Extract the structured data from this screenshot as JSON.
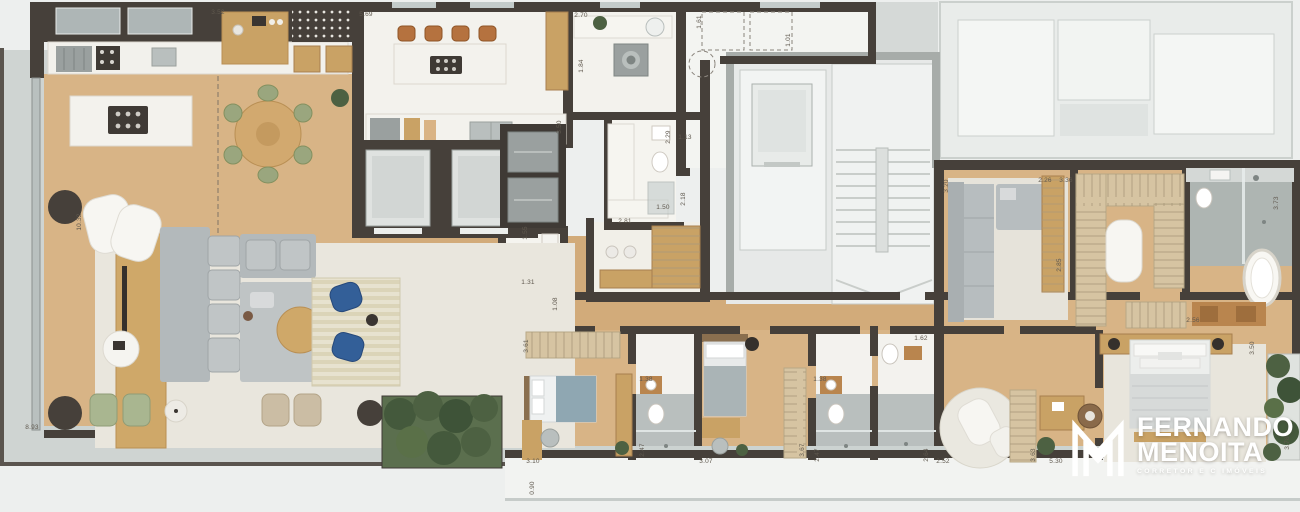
{
  "plan": {
    "kind": "residential floor plan (top-down render)",
    "units": "meters"
  },
  "logo": {
    "line1": "FERNANDO",
    "line2": "MENOITA",
    "tagline": "CORRETOR E C IMÓVEIS",
    "monogram": "M"
  },
  "colors": {
    "background": "#edefee",
    "wall": "#46403a",
    "common_wall": "#a7aca9",
    "wood": "#d8b486",
    "wood_dark": "#cfa875",
    "white_floor": "#f3f2ed",
    "rug": "#e9e6dd",
    "concrete": "#cfd4d2",
    "common_floor": "#e7e9e8",
    "glass": "#bcc4c4",
    "sofa_gray": "#b7bdbf",
    "chair_green": "#a9b690",
    "chair_blue": "#335f98",
    "chair_tan": "#cbbda4",
    "stool_leather": "#b5723f",
    "wardrobe_tan": "#d6c4a2",
    "wood_furniture": "#c9a265",
    "cork": "#b9854e",
    "plant_green": "#4d6142",
    "planter_dark": "#46403a",
    "bath_gray": "#b9bfbe",
    "appliance_gray": "#9aa09f",
    "label_text": "#5f584e",
    "logo_white": "#ffffff"
  },
  "dimensions": [
    {
      "label": "3.52",
      "x": 218,
      "y": 13,
      "vertical": false
    },
    {
      "label": "5.69",
      "x": 366,
      "y": 15,
      "vertical": false
    },
    {
      "label": "2.70",
      "x": 581,
      "y": 16,
      "vertical": false
    },
    {
      "label": "1.61",
      "x": 700,
      "y": 22,
      "vertical": true
    },
    {
      "label": "1.01",
      "x": 789,
      "y": 40,
      "vertical": true
    },
    {
      "label": "10.32",
      "x": 80,
      "y": 222,
      "vertical": true
    },
    {
      "label": "1.84",
      "x": 582,
      "y": 66,
      "vertical": true
    },
    {
      "label": "3.50",
      "x": 560,
      "y": 127,
      "vertical": true
    },
    {
      "label": "1.13",
      "x": 685,
      "y": 138,
      "vertical": false
    },
    {
      "label": "2.29",
      "x": 669,
      "y": 137,
      "vertical": true
    },
    {
      "label": "2.18",
      "x": 684,
      "y": 199,
      "vertical": true
    },
    {
      "label": "1.50",
      "x": 663,
      "y": 208,
      "vertical": false
    },
    {
      "label": "2.81",
      "x": 625,
      "y": 222,
      "vertical": false
    },
    {
      "label": "1.55",
      "x": 526,
      "y": 233,
      "vertical": true
    },
    {
      "label": "1.31",
      "x": 528,
      "y": 283,
      "vertical": false
    },
    {
      "label": "1.08",
      "x": 556,
      "y": 304,
      "vertical": true
    },
    {
      "label": "3.20",
      "x": 947,
      "y": 186,
      "vertical": true
    },
    {
      "label": "2.26",
      "x": 1045,
      "y": 181,
      "vertical": false
    },
    {
      "label": "3.36",
      "x": 1066,
      "y": 181,
      "vertical": false
    },
    {
      "label": "2.85",
      "x": 1060,
      "y": 265,
      "vertical": true
    },
    {
      "label": "3.73",
      "x": 1277,
      "y": 203,
      "vertical": true
    },
    {
      "label": "1.62",
      "x": 921,
      "y": 339,
      "vertical": false
    },
    {
      "label": "2.56",
      "x": 1193,
      "y": 321,
      "vertical": false
    },
    {
      "label": "8.93",
      "x": 32,
      "y": 428,
      "vertical": false
    },
    {
      "label": "3.61",
      "x": 527,
      "y": 346,
      "vertical": true
    },
    {
      "label": "3.10",
      "x": 533,
      "y": 462,
      "vertical": false
    },
    {
      "label": "1.38",
      "x": 646,
      "y": 380,
      "vertical": false
    },
    {
      "label": "2.47",
      "x": 643,
      "y": 450,
      "vertical": true
    },
    {
      "label": "3.07",
      "x": 706,
      "y": 462,
      "vertical": false
    },
    {
      "label": "3.67",
      "x": 803,
      "y": 450,
      "vertical": true
    },
    {
      "label": "1.38",
      "x": 820,
      "y": 380,
      "vertical": false
    },
    {
      "label": "2.47",
      "x": 818,
      "y": 455,
      "vertical": true
    },
    {
      "label": "2.64",
      "x": 927,
      "y": 455,
      "vertical": true
    },
    {
      "label": "2.52",
      "x": 943,
      "y": 462,
      "vertical": false
    },
    {
      "label": "3.63",
      "x": 1034,
      "y": 455,
      "vertical": true
    },
    {
      "label": "5.30",
      "x": 1056,
      "y": 462,
      "vertical": false
    },
    {
      "label": "0.90",
      "x": 533,
      "y": 488,
      "vertical": true
    },
    {
      "label": "3.50",
      "x": 1253,
      "y": 348,
      "vertical": true
    },
    {
      "label": "3.78",
      "x": 1288,
      "y": 443,
      "vertical": true
    }
  ]
}
